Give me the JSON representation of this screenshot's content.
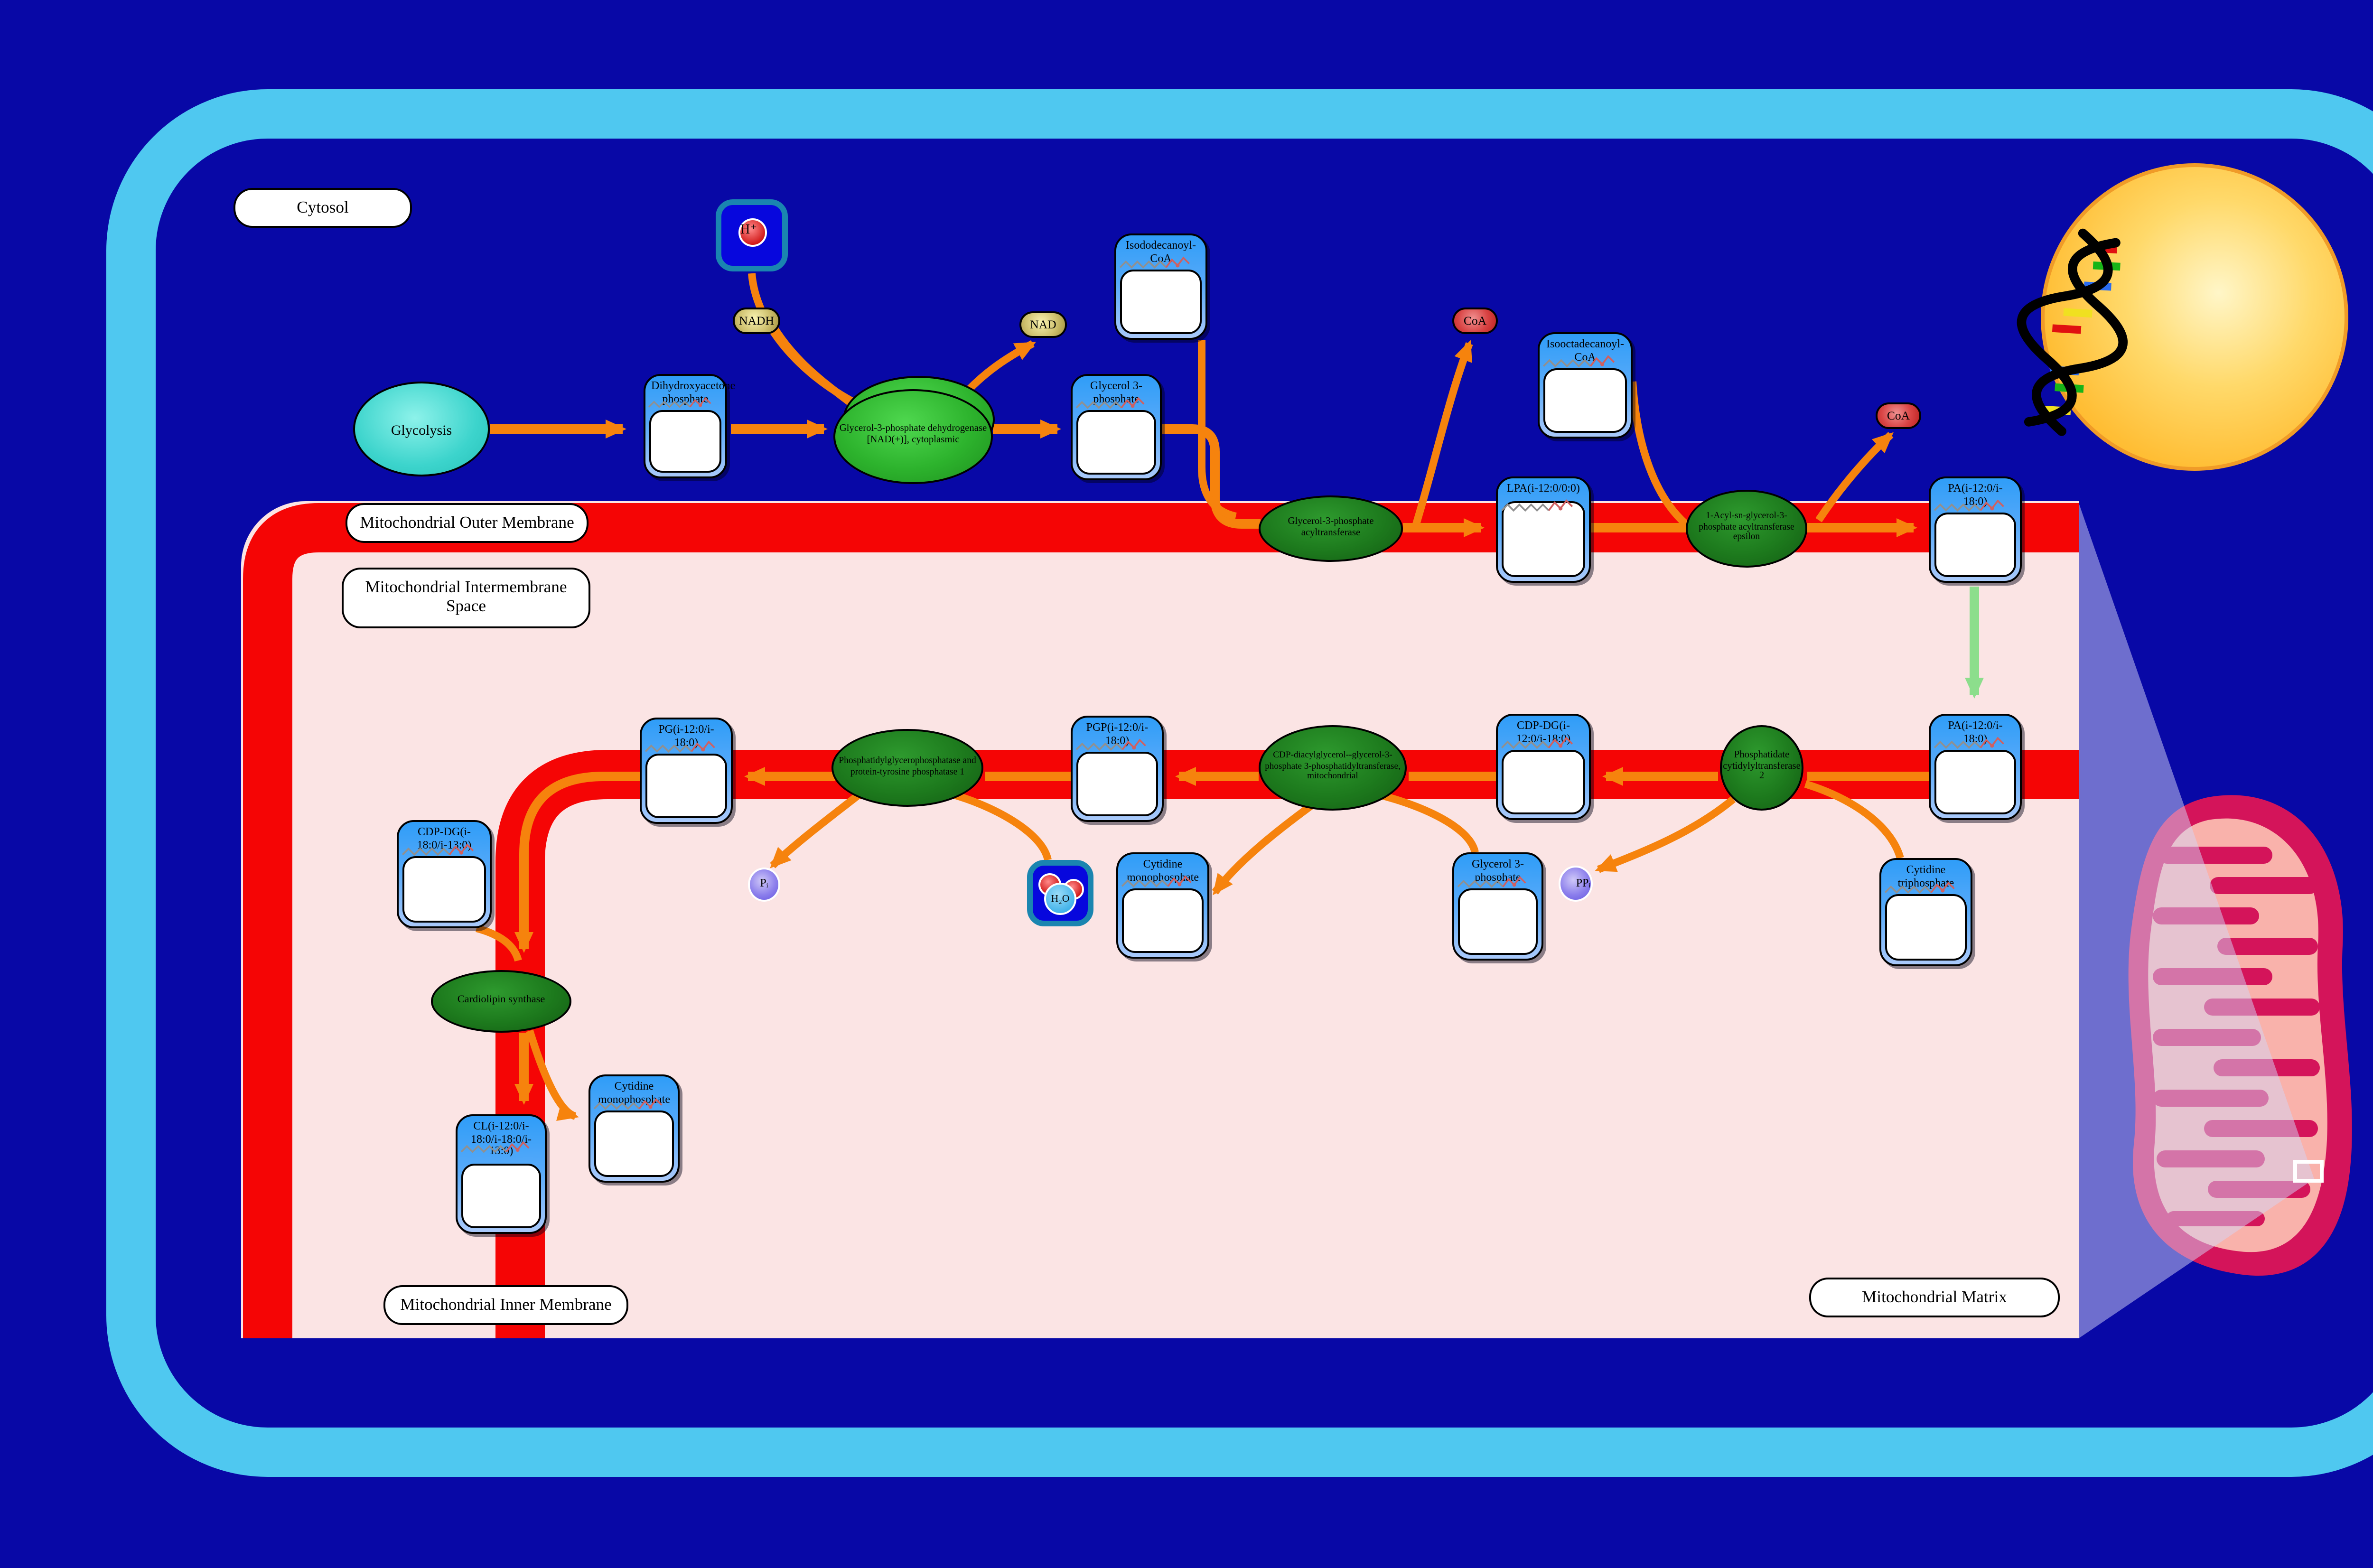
{
  "regions": {
    "cytosol": "Cytosol",
    "outer_membrane": "Mitochondrial Outer Membrane",
    "intermembrane_space": "Mitochondrial Intermembrane Space",
    "inner_membrane": "Mitochondrial Inner Membrane",
    "matrix": "Mitochondrial Matrix"
  },
  "process": {
    "glycolysis": "Glycolysis"
  },
  "nodes": {
    "dhap": "Dihydroxyacetone phosphate",
    "g3p": "Glycerol 3-phosphate",
    "isododecanoyl_coa": "Isododecanoyl-CoA",
    "isooctadecanoyl_coa": "Isooctadecanoyl-CoA",
    "lpa": "LPA(i-12:0/0:0)",
    "pa_outer": "PA(i-12:0/i-18:0)",
    "pa_inner": "PA(i-12:0/i-18:0)",
    "cdp_dg": "CDP-DG(i-12:0/i-18:0)",
    "pgp": "PGP(i-12:0/i-18:0)",
    "pg": "PG(i-12:0/i-18:0)",
    "cdp_dg2": "CDP-DG(i-18:0/i-13:0)",
    "cl": "CL(i-12:0/i-18:0/i-18:0/i-13:0)",
    "cmp1": "Cytidine monophosphate",
    "cmp2": "Cytidine monophosphate",
    "g3p2": "Glycerol 3-phosphate",
    "ctp": "Cytidine triphosphate"
  },
  "enzymes": {
    "gpd": "Glycerol-3-phosphate dehydrogenase [NAD(+)], cytoplasmic",
    "gpat": "Glycerol-3-phosphate acyltransferase",
    "agpat": "1-Acyl-sn-glycerol-3-phosphate acyltransferase epsilon",
    "ptpmt1": "Phosphatidylglycerophosphatase and protein-tyrosine phosphatase 1",
    "cds": "CDP-diacylglycerol--glycerol-3-phosphate 3-phosphatidyltransferase, mitochondrial",
    "pcyt2": "Phosphatidate cytidylyltransferase 2",
    "cls": "Cardiolipin synthase"
  },
  "cofactors": {
    "h_ion": "H⁺",
    "nadh": "NADH",
    "nad": "NAD",
    "coa1": "CoA",
    "coa2": "CoA",
    "pi": "Pᵢ",
    "ppi": "PPᵢ",
    "h2o": "H₂O"
  },
  "colors": {
    "background_navy": "#0808a6",
    "cell_membrane_cyan": "#4fc8f0",
    "membrane_red": "#f50505",
    "compartment_pink": "#fbe4e4",
    "arrow_orange": "#f6830d",
    "transport_green": "#8cde8c",
    "metabolite_header_blue": "#2f9df8",
    "enzyme_green": "#1d7a1d",
    "nucleus_yellow": "#ffbe35",
    "mitochondrion_crimson": "#d4145a",
    "mitochondrion_inner_pink": "#f9b2ab"
  }
}
